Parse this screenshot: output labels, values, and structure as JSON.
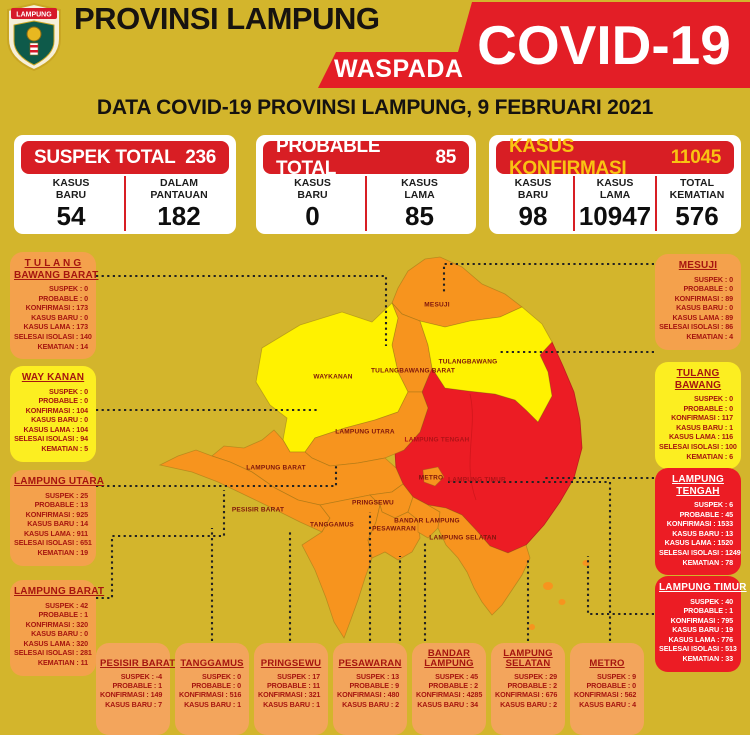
{
  "header": {
    "logo_text": "LAMPUNG",
    "title": "PROVINSI LAMPUNG",
    "ribbon_small": "WASPADA",
    "ribbon_big": "COVID-19",
    "subtitle": "DATA COVID-19 PROVINSI LAMPUNG, 9 FEBRUARI 2021"
  },
  "summary_cards": [
    {
      "title": "SUSPEK TOTAL",
      "total": "236",
      "columns": [
        {
          "label": "KASUS\nBARU",
          "value": "54"
        },
        {
          "label": "DALAM\nPANTAUAN",
          "value": "182"
        }
      ]
    },
    {
      "title": "PROBABLE TOTAL",
      "total": "85",
      "columns": [
        {
          "label": "KASUS\nBARU",
          "value": "0"
        },
        {
          "label": "KASUS\nLAMA",
          "value": "85"
        }
      ]
    },
    {
      "title": "KASUS KONFIRMASI",
      "total": "11045",
      "columns": [
        {
          "label": "KASUS\nBARU",
          "value": "98"
        },
        {
          "label": "KASUS\nLAMA",
          "value": "10947"
        },
        {
          "label": "TOTAL\nKEMATIAN",
          "value": "576"
        }
      ]
    }
  ],
  "stat_labels": [
    "SUSPEK",
    "PROBABLE",
    "KONFIRMASI",
    "KASUS BARU",
    "KASUS LAMA",
    "SELESAI ISOLASI",
    "KEMATIAN"
  ],
  "region_boxes": {
    "left": [
      {
        "id": "tulang-bawang-barat",
        "title_lines": [
          "T U L A N G",
          "BAWANG BARAT"
        ],
        "severity": "orange",
        "values": [
          "0",
          "0",
          "173",
          "0",
          "173",
          "140",
          "14"
        ]
      },
      {
        "id": "way-kanan",
        "title_lines": [
          "WAY KANAN"
        ],
        "severity": "yellow",
        "values": [
          "0",
          "0",
          "104",
          "0",
          "104",
          "94",
          "5"
        ]
      },
      {
        "id": "lampung-utara",
        "title_lines": [
          "LAMPUNG UTARA"
        ],
        "severity": "orange",
        "values": [
          "25",
          "13",
          "925",
          "14",
          "911",
          "651",
          "19"
        ]
      },
      {
        "id": "lampung-barat",
        "title_lines": [
          "LAMPUNG BARAT"
        ],
        "severity": "orange",
        "values": [
          "42",
          "1",
          "320",
          "0",
          "320",
          "281",
          "11"
        ]
      }
    ],
    "right": [
      {
        "id": "mesuji",
        "title_lines": [
          "MESUJI"
        ],
        "severity": "orange",
        "values": [
          "0",
          "0",
          "89",
          "0",
          "89",
          "86",
          "4"
        ]
      },
      {
        "id": "tulang-bawang",
        "title_lines": [
          "TULANG",
          "BAWANG"
        ],
        "severity": "yellow",
        "values": [
          "0",
          "0",
          "117",
          "1",
          "116",
          "100",
          "6"
        ]
      },
      {
        "id": "lampung-tengah",
        "title_lines": [
          "LAMPUNG",
          "TENGAH"
        ],
        "severity": "red",
        "values": [
          "6",
          "45",
          "1533",
          "13",
          "1520",
          "1249",
          "78"
        ]
      },
      {
        "id": "lampung-timur",
        "title_lines": [
          "LAMPUNG TIMUR"
        ],
        "severity": "red",
        "values": [
          "40",
          "1",
          "795",
          "19",
          "776",
          "513",
          "33"
        ]
      }
    ],
    "bottom": [
      {
        "id": "pesisir-barat",
        "title_lines": [
          "PESISIR BARAT"
        ],
        "severity": "orange-light",
        "values": [
          "-4",
          "1",
          "149",
          "7"
        ]
      },
      {
        "id": "tanggamus",
        "title_lines": [
          "TANGGAMUS"
        ],
        "severity": "orange-light",
        "values": [
          "0",
          "0",
          "516",
          "1"
        ]
      },
      {
        "id": "pringsewu",
        "title_lines": [
          "PRINGSEWU"
        ],
        "severity": "orange-light",
        "values": [
          "17",
          "11",
          "321",
          "1"
        ]
      },
      {
        "id": "pesawaran",
        "title_lines": [
          "PESAWARAN"
        ],
        "severity": "orange-light",
        "values": [
          "13",
          "9",
          "480",
          "2"
        ]
      },
      {
        "id": "bandar-lampung",
        "title_lines": [
          "BANDAR",
          "LAMPUNG"
        ],
        "severity": "orange-light",
        "values": [
          "45",
          "2",
          "4285",
          "34"
        ]
      },
      {
        "id": "lampung-selatan",
        "title_lines": [
          "LAMPUNG",
          "SELATAN"
        ],
        "severity": "orange-light",
        "values": [
          "29",
          "2",
          "676",
          "2"
        ]
      },
      {
        "id": "metro",
        "title_lines": [
          "METRO"
        ],
        "severity": "orange-light",
        "values": [
          "9",
          "0",
          "562",
          "4"
        ]
      }
    ]
  },
  "map_labels": [
    "MESUJI",
    "WAYKANAN",
    "TULANGBAWANG BARAT",
    "TULANGBAWANG",
    "LAMPUNG UTARA",
    "LAMPUNG TENGAH",
    "METRO",
    "LAMPUNG TIMUR",
    "LAMPUNG BARAT",
    "PESISIR BARAT",
    "TANGGAMUS",
    "PRINGSEWU",
    "PESAWARAN",
    "BANDAR LAMPUNG",
    "LAMPUNG SELATAN"
  ],
  "colors": {
    "background": "#D3B52C",
    "red": "#E31E26",
    "card_header_red": "#D81E24",
    "konfirmasi_gold": "#F9C312",
    "orange_box": "#F4A14C",
    "orange_box_bottom": "#F3A55C",
    "yellow_box": "#FCEE21",
    "red_box": "#EC1C24",
    "map_orange": "#F7941E",
    "map_yellow": "#FFF200",
    "map_red": "#EC1C24",
    "dark_red_text": "#A6150F"
  }
}
